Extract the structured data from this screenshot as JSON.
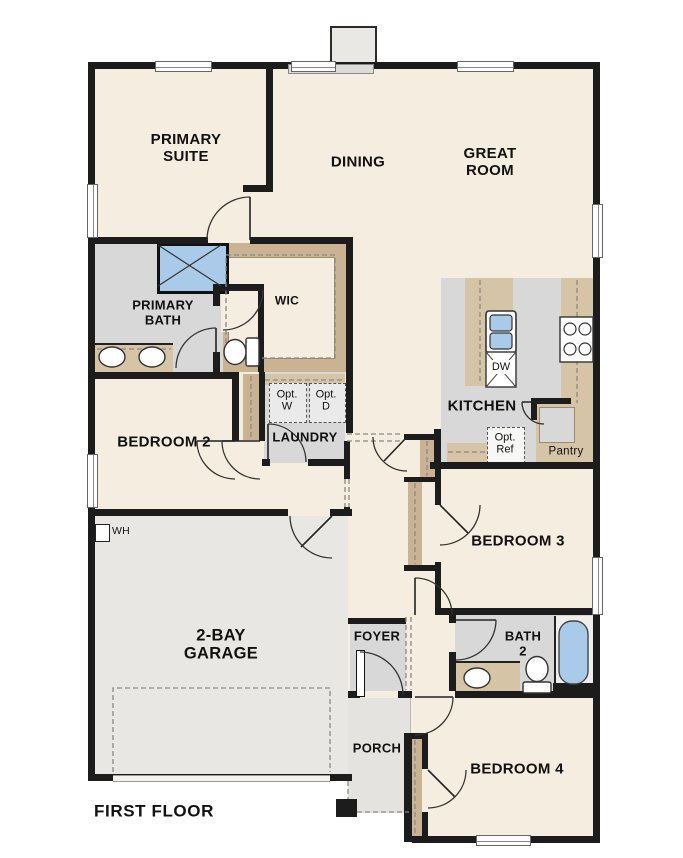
{
  "plan_title": "FIRST FLOOR",
  "rooms": {
    "primary_suite": "PRIMARY\nSUITE",
    "dining": "DINING",
    "great_room": "GREAT\nROOM",
    "primary_bath": "PRIMARY\nBATH",
    "wic": "WIC",
    "laundry": "LAUNDRY",
    "bedroom_2": "BEDROOM 2",
    "kitchen": "KITCHEN",
    "pantry": "Pantry",
    "bedroom_3": "BEDROOM 3",
    "garage": "2-BAY\nGARAGE",
    "foyer": "FOYER",
    "bath_2": "BATH\n2",
    "porch": "PORCH",
    "bedroom_4": "BEDROOM 4"
  },
  "appliances": {
    "dishwasher": "DW",
    "optional_washer": "Opt.\nW",
    "optional_dryer": "Opt.\nD",
    "optional_refrigerator": "Opt.\nRef",
    "water_heater": "WH"
  },
  "colors": {
    "floor_beige": "#f4ede0",
    "room_gray": "#d8d8d8",
    "garage_gray": "#e8e7e4",
    "porch_gray": "#e4e3e0",
    "counter_tan": "#d5c5a6",
    "closet_tan": "#c9b392",
    "fixture_blue": "#a9cbe9",
    "wall_black": "#1c1c1c"
  }
}
